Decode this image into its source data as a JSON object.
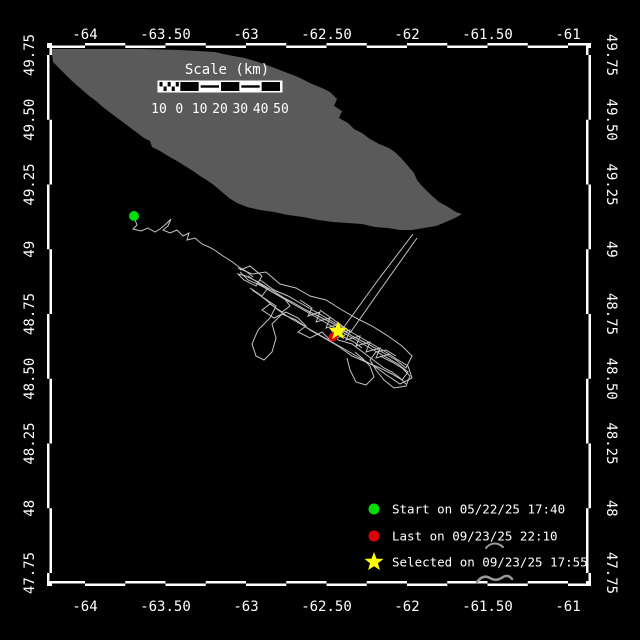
{
  "title": "Animal track map",
  "colors": {
    "background": "#000000",
    "frame_white": "#ffffff",
    "frame_black": "#000000",
    "land": "#5a5a5a",
    "track": "#c4c4c4",
    "text": "#ffffff",
    "start": "#00dd00",
    "last": "#e00000",
    "selected": "#ffff00",
    "artifact": "#999999"
  },
  "axes": {
    "lon_ticks": [
      {
        "label": "-64",
        "value": -64.0
      },
      {
        "label": "-63.50",
        "value": -63.5
      },
      {
        "label": "-63",
        "value": -63.0
      },
      {
        "label": "-62.50",
        "value": -62.5
      },
      {
        "label": "-62",
        "value": -62.0
      },
      {
        "label": "-61.50",
        "value": -61.5
      },
      {
        "label": "-61",
        "value": -61.0
      }
    ],
    "lat_ticks": [
      {
        "label": "49.75",
        "value": 49.75
      },
      {
        "label": "49.50",
        "value": 49.5
      },
      {
        "label": "49.25",
        "value": 49.25
      },
      {
        "label": "49",
        "value": 49.0
      },
      {
        "label": "48.75",
        "value": 48.75
      },
      {
        "label": "48.50",
        "value": 48.5
      },
      {
        "label": "48.25",
        "value": 48.25
      },
      {
        "label": "48",
        "value": 48.0
      },
      {
        "label": "47.75",
        "value": 47.75
      }
    ],
    "calibration": {
      "x_at_lon_minus64": 85,
      "px_per_deg_lon": 161,
      "y_at_lat_49_75": 55,
      "px_per_deg_lat": 259,
      "frame": {
        "left": 52,
        "right": 586,
        "top": 48,
        "bottom": 581,
        "band": 5
      }
    }
  },
  "scalebar": {
    "title": "Scale (km)",
    "labels": [
      "10",
      "0",
      "10",
      "20",
      "30",
      "40",
      "50"
    ],
    "x_start": 159,
    "y_top": 82,
    "seg_width": 20.33,
    "height": 9,
    "title_x": 227,
    "title_y": 74,
    "label_y": 113,
    "segments": [
      "checker",
      "black",
      "midline",
      "black",
      "midline",
      "black"
    ]
  },
  "legend": {
    "items": [
      {
        "marker": "circle",
        "color_key": "start",
        "label": "Start on 05/22/25 17:40"
      },
      {
        "marker": "circle",
        "color_key": "last",
        "label": "Last on 09/23/25 22:10"
      },
      {
        "marker": "star",
        "color_key": "selected",
        "label": "Selected on 09/23/25 17:55"
      }
    ],
    "marker_x": 374,
    "text_x": 392,
    "row_y": [
      509,
      536,
      562
    ]
  },
  "map": {
    "island": {
      "name": "landmass",
      "points": [
        [
          52,
          49
        ],
        [
          140,
          49
        ],
        [
          180,
          50
        ],
        [
          215,
          52
        ],
        [
          228,
          55
        ],
        [
          245,
          58
        ],
        [
          258,
          62
        ],
        [
          272,
          67
        ],
        [
          285,
          72
        ],
        [
          298,
          77
        ],
        [
          312,
          84
        ],
        [
          322,
          88
        ],
        [
          330,
          92
        ],
        [
          337,
          99
        ],
        [
          334,
          106
        ],
        [
          342,
          111
        ],
        [
          339,
          118
        ],
        [
          348,
          123
        ],
        [
          354,
          129
        ],
        [
          362,
          133
        ],
        [
          370,
          139
        ],
        [
          379,
          144
        ],
        [
          389,
          148
        ],
        [
          396,
          153
        ],
        [
          402,
          159
        ],
        [
          408,
          166
        ],
        [
          414,
          173
        ],
        [
          417,
          180
        ],
        [
          422,
          186
        ],
        [
          430,
          194
        ],
        [
          439,
          202
        ],
        [
          448,
          207
        ],
        [
          456,
          212
        ],
        [
          462,
          214
        ],
        [
          455,
          218
        ],
        [
          446,
          222
        ],
        [
          436,
          226
        ],
        [
          424,
          228
        ],
        [
          412,
          230
        ],
        [
          400,
          230
        ],
        [
          388,
          228
        ],
        [
          375,
          227
        ],
        [
          362,
          224
        ],
        [
          348,
          223
        ],
        [
          333,
          222
        ],
        [
          318,
          220
        ],
        [
          303,
          217
        ],
        [
          288,
          215
        ],
        [
          274,
          212
        ],
        [
          260,
          210
        ],
        [
          247,
          207
        ],
        [
          237,
          203
        ],
        [
          229,
          198
        ],
        [
          222,
          192
        ],
        [
          215,
          186
        ],
        [
          208,
          181
        ],
        [
          200,
          176
        ],
        [
          193,
          171
        ],
        [
          185,
          166
        ],
        [
          177,
          161
        ],
        [
          168,
          156
        ],
        [
          160,
          151
        ],
        [
          152,
          147
        ],
        [
          150,
          141
        ],
        [
          144,
          138
        ],
        [
          136,
          132
        ],
        [
          128,
          126
        ],
        [
          120,
          120
        ],
        [
          112,
          114
        ],
        [
          104,
          108
        ],
        [
          96,
          101
        ],
        [
          88,
          95
        ],
        [
          80,
          88
        ],
        [
          72,
          81
        ],
        [
          64,
          73
        ],
        [
          58,
          67
        ],
        [
          53,
          62
        ],
        [
          52,
          55
        ]
      ]
    },
    "track": {
      "strokes": [
        [
          [
            134,
            217
          ],
          [
            137,
            225
          ],
          [
            133,
            229
          ],
          [
            141,
            231
          ],
          [
            148,
            228
          ],
          [
            155,
            232
          ],
          [
            160,
            229
          ],
          [
            166,
            224
          ],
          [
            171,
            219
          ],
          [
            168,
            226
          ],
          [
            163,
            230
          ],
          [
            170,
            233
          ],
          [
            177,
            230
          ],
          [
            183,
            236
          ],
          [
            189,
            233
          ],
          [
            187,
            240
          ],
          [
            195,
            238
          ],
          [
            202,
            244
          ],
          [
            209,
            247
          ],
          [
            216,
            251
          ],
          [
            223,
            256
          ],
          [
            231,
            261
          ],
          [
            239,
            267
          ],
          [
            247,
            272
          ],
          [
            253,
            277
          ]
        ],
        [
          [
            238,
            268
          ],
          [
            252,
            274
          ],
          [
            266,
            272
          ],
          [
            280,
            284
          ],
          [
            296,
            288
          ],
          [
            310,
            296
          ],
          [
            326,
            300
          ],
          [
            342,
            310
          ],
          [
            356,
            318
          ],
          [
            372,
            326
          ],
          [
            388,
            336
          ],
          [
            402,
            346
          ],
          [
            412,
            356
          ],
          [
            406,
            368
          ],
          [
            396,
            360
          ],
          [
            382,
            352
          ],
          [
            368,
            344
          ],
          [
            352,
            336
          ],
          [
            338,
            326
          ],
          [
            322,
            318
          ],
          [
            306,
            310
          ],
          [
            292,
            302
          ],
          [
            276,
            294
          ],
          [
            262,
            286
          ],
          [
            248,
            280
          ],
          [
            240,
            272
          ]
        ],
        [
          [
            252,
            290
          ],
          [
            264,
            298
          ],
          [
            276,
            306
          ],
          [
            270,
            318
          ],
          [
            258,
            330
          ],
          [
            252,
            344
          ],
          [
            256,
            356
          ],
          [
            264,
            360
          ],
          [
            272,
            352
          ],
          [
            276,
            338
          ],
          [
            272,
            324
          ],
          [
            282,
            314
          ],
          [
            296,
            320
          ],
          [
            310,
            330
          ],
          [
            324,
            338
          ],
          [
            338,
            346
          ],
          [
            352,
            356
          ],
          [
            366,
            362
          ],
          [
            380,
            368
          ],
          [
            392,
            374
          ],
          [
            402,
            380
          ],
          [
            408,
            372
          ],
          [
            398,
            364
          ],
          [
            384,
            356
          ],
          [
            370,
            348
          ],
          [
            356,
            340
          ],
          [
            342,
            332
          ],
          [
            328,
            324
          ],
          [
            314,
            316
          ],
          [
            300,
            308
          ],
          [
            286,
            300
          ],
          [
            272,
            292
          ],
          [
            258,
            284
          ]
        ],
        [
          [
            260,
            280
          ],
          [
            274,
            290
          ],
          [
            288,
            296
          ],
          [
            302,
            304
          ],
          [
            316,
            312
          ],
          [
            330,
            320
          ],
          [
            344,
            328
          ],
          [
            358,
            336
          ],
          [
            372,
            344
          ],
          [
            386,
            352
          ],
          [
            398,
            360
          ],
          [
            408,
            366
          ],
          [
            412,
            378
          ],
          [
            400,
            384
          ],
          [
            388,
            376
          ],
          [
            374,
            366
          ],
          [
            360,
            358
          ],
          [
            346,
            350
          ],
          [
            332,
            342
          ],
          [
            318,
            334
          ],
          [
            304,
            326
          ],
          [
            290,
            318
          ],
          [
            278,
            310
          ],
          [
            266,
            300
          ],
          [
            256,
            292
          ]
        ],
        [
          [
            380,
            356
          ],
          [
            392,
            362
          ],
          [
            402,
            368
          ],
          [
            410,
            376
          ],
          [
            406,
            386
          ],
          [
            394,
            388
          ],
          [
            384,
            380
          ],
          [
            376,
            370
          ],
          [
            370,
            360
          ],
          [
            376,
            352
          ],
          [
            386,
            350
          ],
          [
            396,
            356
          ]
        ],
        [
          [
            300,
            300
          ],
          [
            312,
            308
          ],
          [
            308,
            316
          ],
          [
            320,
            312
          ],
          [
            316,
            322
          ],
          [
            330,
            318
          ],
          [
            326,
            328
          ],
          [
            340,
            324
          ],
          [
            336,
            334
          ],
          [
            350,
            330
          ],
          [
            346,
            340
          ],
          [
            360,
            336
          ],
          [
            356,
            346
          ],
          [
            370,
            342
          ],
          [
            366,
            352
          ],
          [
            380,
            348
          ],
          [
            376,
            358
          ],
          [
            390,
            354
          ]
        ],
        [
          [
            240,
            270
          ],
          [
            250,
            266
          ],
          [
            262,
            276
          ],
          [
            256,
            286
          ],
          [
            244,
            280
          ],
          [
            238,
            274
          ],
          [
            246,
            276
          ],
          [
            258,
            282
          ],
          [
            268,
            288
          ],
          [
            262,
            296
          ],
          [
            250,
            288
          ]
        ],
        [
          [
            347,
            358
          ],
          [
            350,
            370
          ],
          [
            356,
            382
          ],
          [
            366,
            385
          ],
          [
            374,
            377
          ],
          [
            370,
            366
          ],
          [
            362,
            358
          ],
          [
            355,
            352
          ]
        ],
        [
          [
            344,
            327
          ],
          [
            378,
            280
          ],
          [
            413,
            234
          ]
        ],
        [
          [
            350,
            333
          ],
          [
            383,
            286
          ],
          [
            417,
            238
          ]
        ],
        [
          [
            320,
            310
          ],
          [
            334,
            320
          ],
          [
            348,
            330
          ],
          [
            344,
            336
          ],
          [
            330,
            328
          ],
          [
            338,
            340
          ],
          [
            352,
            344
          ],
          [
            360,
            350
          ],
          [
            368,
            356
          ],
          [
            376,
            362
          ],
          [
            384,
            368
          ],
          [
            392,
            372
          ],
          [
            400,
            378
          ],
          [
            406,
            384
          ]
        ],
        [
          [
            248,
            276
          ],
          [
            260,
            284
          ],
          [
            272,
            290
          ],
          [
            284,
            298
          ],
          [
            290,
            306
          ],
          [
            282,
            312
          ],
          [
            270,
            304
          ],
          [
            262,
            310
          ],
          [
            274,
            318
          ],
          [
            286,
            312
          ],
          [
            298,
            318
          ],
          [
            306,
            326
          ],
          [
            298,
            332
          ],
          [
            310,
            338
          ],
          [
            322,
            332
          ],
          [
            330,
            340
          ],
          [
            342,
            336
          ],
          [
            354,
            342
          ],
          [
            362,
            348
          ]
        ]
      ]
    },
    "markers": {
      "start": {
        "x": 134,
        "y": 216,
        "r": 5
      },
      "last": {
        "x": 333,
        "y": 337,
        "r": 4.5
      },
      "selected": {
        "x": 338,
        "y": 331,
        "R": 10,
        "r": 4.2
      }
    }
  },
  "artifacts": [
    {
      "d": "M 486 548 Q 491 542 498 544 Q 501 545 503 547",
      "w": 2
    },
    {
      "d": "M 477 582 Q 483 574 490 578 Q 496 582 503 577 Q 508 574 512 579",
      "w": 2.5
    }
  ]
}
